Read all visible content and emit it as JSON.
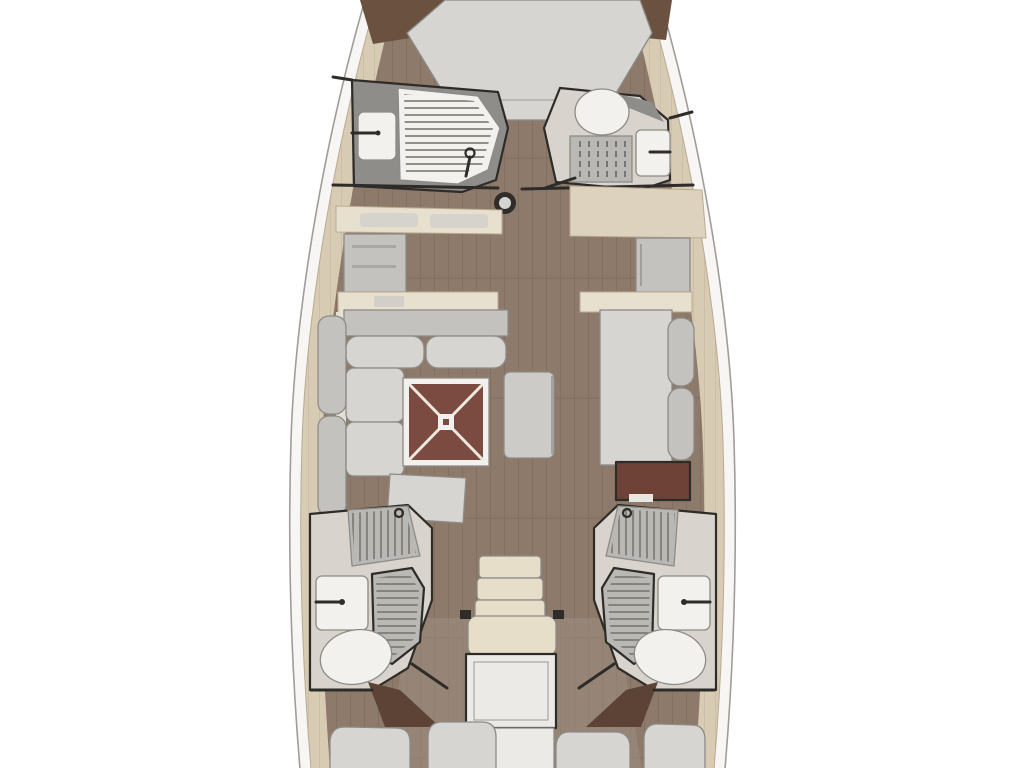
{
  "meta": {
    "description": "Sailboat interior layout floor plan, bow up: V-berth forward, two forward heads, galley and salon amidships with red salon table, two aft heads, companionway stairs and twin aft cabins"
  },
  "fixtures": [
    "hull-outline",
    "deck-band",
    "cabin-sole",
    "vberth-bed",
    "fwd-head-port-shower",
    "fwd-head-port-sink",
    "fwd-head-stbd-toilet",
    "fwd-head-stbd-sink",
    "mast-post",
    "galley-counter",
    "galley-cabinet",
    "stbd-counter",
    "stbd-locker",
    "port-sofa",
    "salon-table",
    "salon-stool",
    "stbd-settee",
    "chart-locker",
    "aft-head-port-shower",
    "aft-head-port-sink",
    "aft-head-port-toilet",
    "aft-head-stbd-shower",
    "aft-head-stbd-sink",
    "aft-head-stbd-toilet",
    "companionway-steps",
    "engine-box",
    "aft-cabin-port-bed",
    "aft-cabin-stbd-bed"
  ],
  "colors": {
    "background": "#ffffff",
    "hull_band": "#f7f6f4",
    "hull_stroke": "#a09d98",
    "deck_beige": "#d8cbb4",
    "deck_plank_line": "#c2b299",
    "wood_floor": "#8e7a6a",
    "wood_plank_line": "#7d6c5c",
    "wood_floor_light": "#9d8e80",
    "wood_dark_trim": "#6a5140",
    "partition_dark": "#2e2c29",
    "furniture_gray": "#cccbc7",
    "cushion_gray": "#c3c2bf",
    "cushion_light": "#d6d5d2",
    "fixture_white": "#f2f1ee",
    "head_floor_gray": "#d8d4cd",
    "head_panel_dark": "#8e8d8a",
    "grate_gray": "#b9b8b5",
    "grate_line": "#77766f",
    "counter_beige": "#e8e0ce",
    "counter_beige_dark": "#ddd2bd",
    "cabinet_gray": "#c4c2be",
    "table_red": "#7b4b42",
    "desk_red": "#6e4237",
    "stairs_cream": "#e7dec9",
    "engine_white": "#eceae6",
    "bed_gray": "#d6d5d2",
    "pillow_gray": "#d3d2cf",
    "mast_dark": "#2f2d2a",
    "mast_center": "#d5d4d1",
    "wedge_brown": "#5c4336"
  }
}
